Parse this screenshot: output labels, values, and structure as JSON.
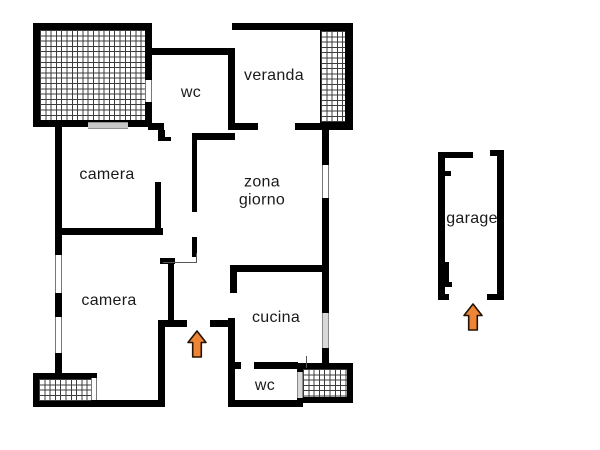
{
  "figure": {
    "type": "floor-plan",
    "labels": {
      "wc_top": "wc",
      "veranda": "veranda",
      "camera_top": "camera",
      "zona_line1": "zona",
      "zona_line2": "giorno",
      "camera_bottom": "camera",
      "cucina": "cucina",
      "wc_bottom": "wc",
      "garage": "garage"
    },
    "colors": {
      "wall": "#000000",
      "arrow_fill": "#ee8435",
      "arrow_stroke": "#241405",
      "label": "#1a1a1a",
      "background": "#ffffff"
    }
  }
}
